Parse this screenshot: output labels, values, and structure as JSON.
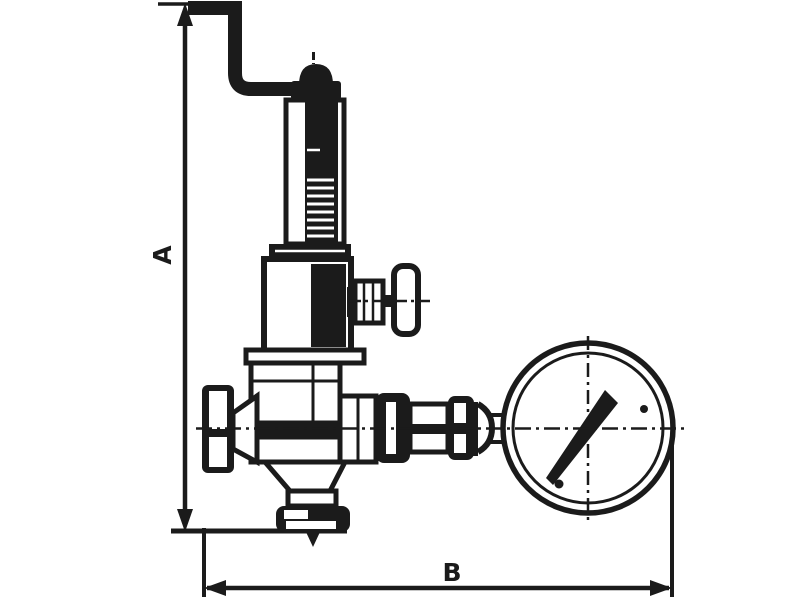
{
  "canvas": {
    "width": 800,
    "height": 598,
    "background_color": "#ffffff",
    "ink_color": "#1b1b1b"
  },
  "dimensions": {
    "vertical_label": "A",
    "horizontal_label": "B"
  },
  "components": [
    "vertical-dimension-a",
    "horizontal-dimension-b",
    "lever-handle",
    "adjusting-cap",
    "spring-housing",
    "housing-flange",
    "spring-bonnet",
    "side-test-valve",
    "valve-body",
    "inlet-union-nut",
    "outlet-flange",
    "gauge-connection-fittings",
    "pressure-gauge",
    "gauge-needle",
    "centerlines"
  ]
}
